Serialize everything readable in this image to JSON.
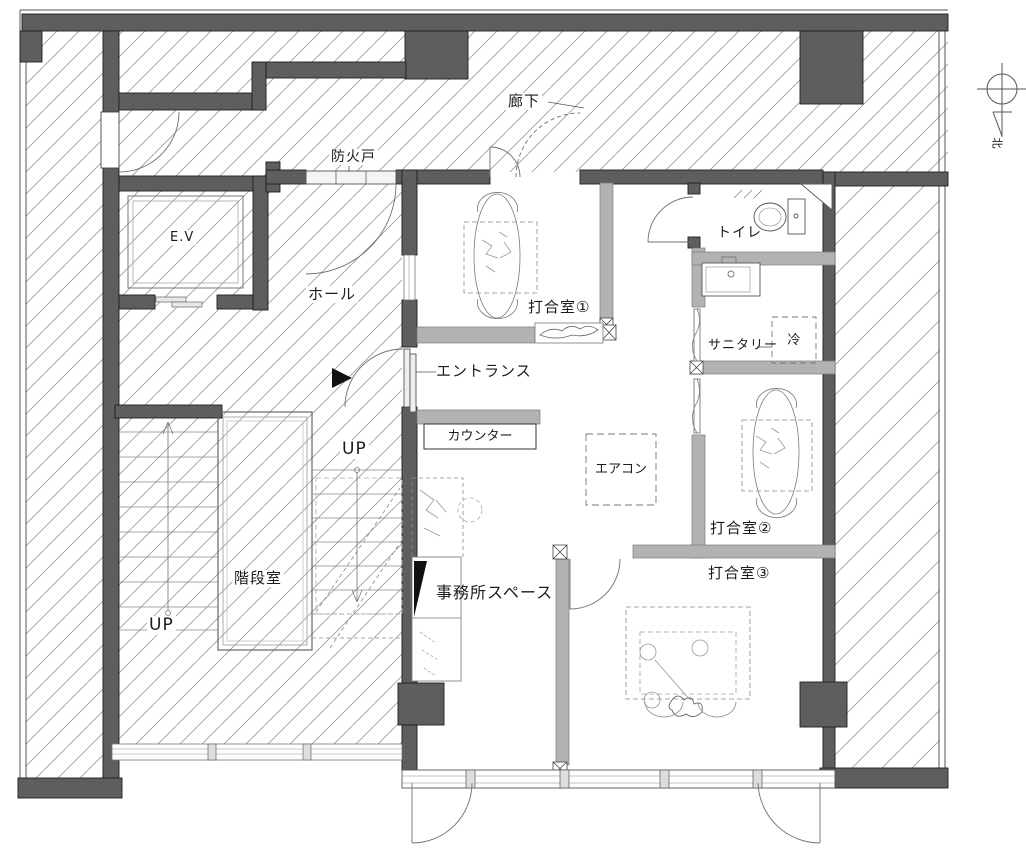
{
  "labels": {
    "corridor": "廊下",
    "fire_door": "防火戸",
    "elevator": "E.V",
    "hall": "ホール",
    "entrance": "エントランス",
    "counter": "カウンター",
    "stairwell": "階段室",
    "up_left": "UP",
    "up_right": "UP",
    "office_space": "事務所スペース",
    "meeting_room_1": "打合室①",
    "meeting_room_2": "打合室②",
    "meeting_room_3": "打合室③",
    "toilet": "トイレ",
    "sanitary": "サニタリー",
    "refrigerator": "冷",
    "air_conditioner": "エアコン",
    "north": "北"
  },
  "colors": {
    "wall_dark": "#5e5e5e",
    "wall_partition": "#b2b2b2",
    "hatch_line": "#9a9a9a",
    "line": "#333333",
    "background": "#ffffff"
  }
}
